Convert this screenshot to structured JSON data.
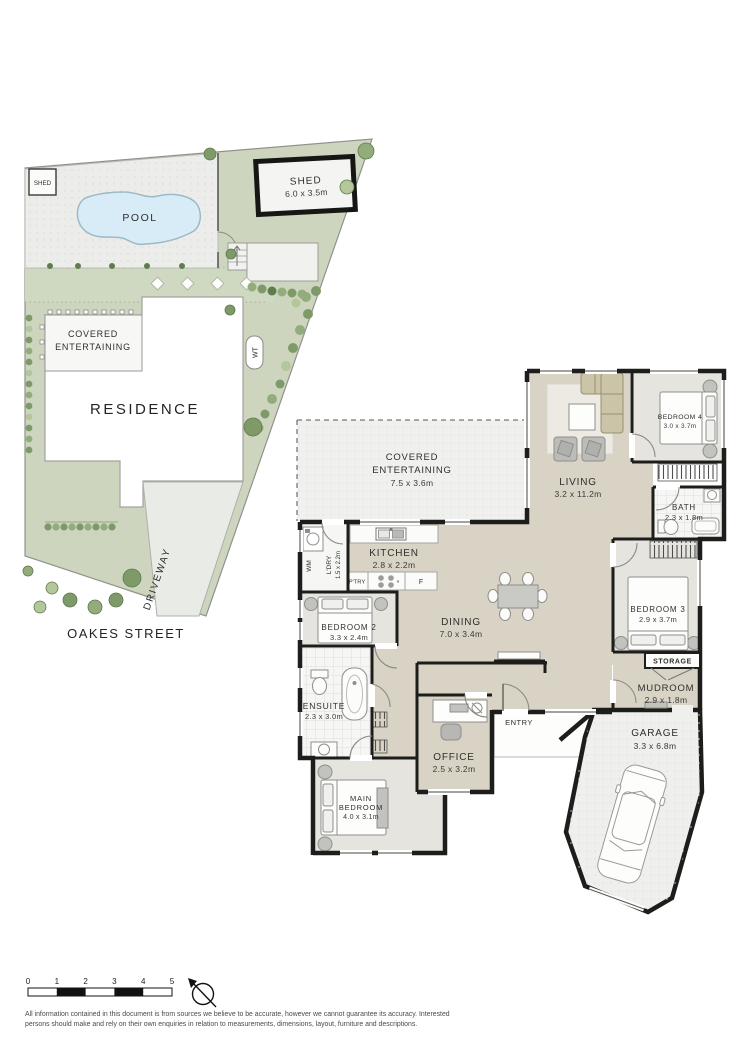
{
  "site_plan": {
    "street_label": "OAKES STREET",
    "residence_label": "RESIDENCE",
    "pool_label": "POOL",
    "driveway_label": "DRIVEWAY",
    "small_shed_label": "SHED",
    "water_tank_label": "WT",
    "shed": {
      "name": "SHED",
      "dims": "6.0 x 3.5m"
    },
    "covered_entertaining": {
      "line1": "COVERED",
      "line2": "ENTERTAINING"
    }
  },
  "floor_plan": {
    "covered_entertaining": {
      "line1": "COVERED",
      "line2": "ENTERTAINING",
      "dims": "7.5 x 3.6m"
    },
    "living": {
      "name": "LIVING",
      "dims": "3.2 x 11.2m"
    },
    "bedroom4": {
      "name": "BEDROOM 4",
      "dims": "3.0 x 3.7m"
    },
    "bath": {
      "name": "BATH",
      "dims": "2.3 x 1.8m"
    },
    "kitchen": {
      "name": "KITCHEN",
      "dims": "2.8 x 2.2m"
    },
    "laundry": {
      "name": "L'DRY",
      "dims": "1.5 x 2.2m"
    },
    "wm": "WM",
    "pantry": "P'TRY",
    "fridge": "F",
    "dining": {
      "name": "DINING",
      "dims": "7.0 x 3.4m"
    },
    "bedroom2": {
      "name": "BEDROOM 2",
      "dims": "3.3 x 2.4m"
    },
    "ensuite": {
      "name": "ENSUITE",
      "dims": "2.3 x 3.0m"
    },
    "main_bedroom": {
      "line1": "MAIN",
      "line2": "BEDROOM",
      "dims": "4.0 x 3.1m"
    },
    "office": {
      "name": "OFFICE",
      "dims": "2.5 x 3.2m"
    },
    "entry": "ENTRY",
    "bedroom3": {
      "name": "BEDROOM 3",
      "dims": "2.9 x 3.7m"
    },
    "storage": "STORAGE",
    "mudroom": {
      "name": "MUDROOM",
      "dims": "2.9 x 1.8m"
    },
    "garage": {
      "name": "GARAGE",
      "dims": "3.3 x 6.8m"
    }
  },
  "scale_bar": {
    "ticks": [
      "0",
      "1",
      "2",
      "3",
      "4",
      "5"
    ]
  },
  "disclaimer": {
    "line1": "All information contained in this document is from sources we believe to be accurate, however we cannot guarantee its accuracy. Interested",
    "line2": "persons should make and rely on their own enquiries in relation to measurements, dimensions, layout, furniture and descriptions."
  },
  "colors": {
    "grass": "#cdd5bf",
    "paving": "#ecedea",
    "pool": "#d8ecf8",
    "floor_open": "#d9d3c6",
    "floor_bedroom": "#e5e4df",
    "floor_tile": "#f6f6f4",
    "floor_outdoor": "#f0f1ee",
    "wall": "#1d1d1b"
  }
}
